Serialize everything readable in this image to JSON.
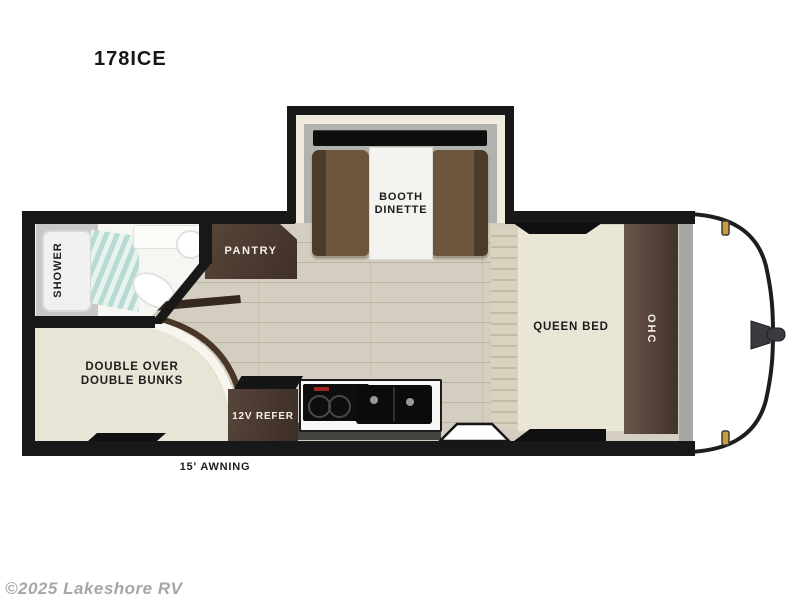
{
  "title": "178ICE",
  "floorplan": {
    "slide_out": {
      "label": "BOOTH DINETTE"
    },
    "bathroom": {
      "shower_label": "SHOWER"
    },
    "pantry": {
      "label": "PANTRY"
    },
    "bunks": {
      "label": "DOUBLE OVER DOUBLE BUNKS"
    },
    "kitchen": {
      "refrigerator_label": "12V REFER"
    },
    "bedroom": {
      "bed_label": "QUEEN BED",
      "overhead_cabinet_label": "OHC"
    },
    "awning": {
      "label": "15' AWNING"
    },
    "colors": {
      "wall": "#181818",
      "floor_wood": "#d3cebf",
      "cabinet_wood": "#4a392e",
      "dinette_upholstery": "#6d543c",
      "bed_fabric": "#e9e5d6",
      "slide_floor": "#b1b1ae",
      "shower_glass": "#b7dad3",
      "clearance_light": "#ce9c37"
    }
  },
  "footer": {
    "watermark": "©2025 Lakeshore RV"
  }
}
